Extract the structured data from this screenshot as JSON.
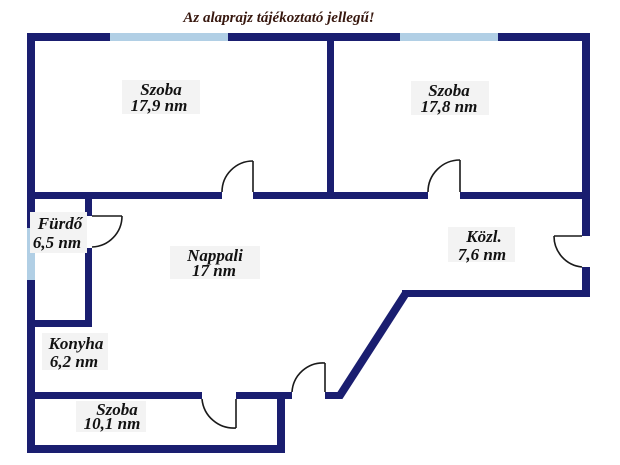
{
  "disclaimer": "Az alaprajz tájékoztató jellegű!",
  "rooms": [
    {
      "name": "Szoba",
      "area": "17,9 nm"
    },
    {
      "name": "Szoba",
      "area": "17,8 nm"
    },
    {
      "name": "Fürdő",
      "area": "6,5 nm"
    },
    {
      "name": "Nappali",
      "area": "17 nm"
    },
    {
      "name": "Közl.",
      "area": "7,6 nm"
    },
    {
      "name": "Konyha",
      "area": "6,2 nm"
    },
    {
      "name": "Szoba",
      "area": "10,1 nm"
    }
  ],
  "colors": {
    "wall": "#1a1e70",
    "window": "#b1cfe5",
    "door": "#1a1a1a",
    "title_text": "#38180f",
    "room_text": "#121212",
    "label_bg": "#f3f3f3",
    "background": "#ffffff"
  }
}
